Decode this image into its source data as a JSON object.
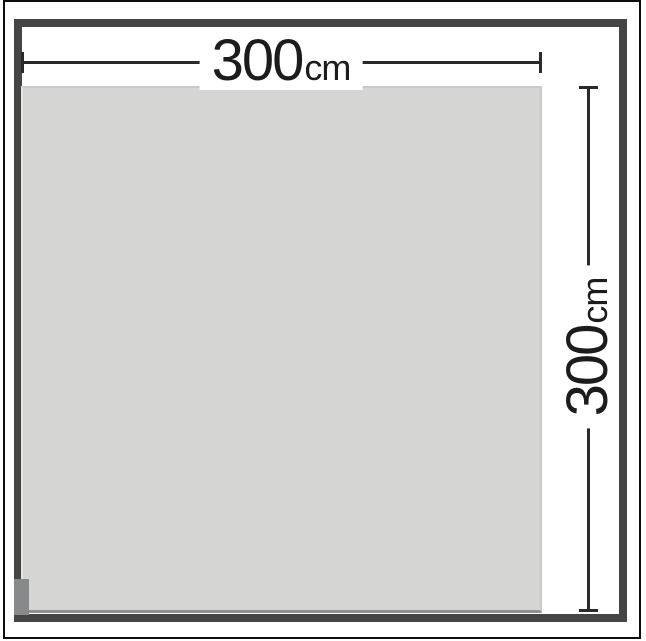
{
  "diagram": {
    "type": "product-dimension-diagram",
    "shape": "square-panel",
    "width_dimension": {
      "value": "300",
      "unit": "cm"
    },
    "height_dimension": {
      "value": "300",
      "unit": "cm"
    },
    "colors": {
      "canvas_background": "#ffffff",
      "outer_border": "#0d0d0d",
      "frame": "#454545",
      "panel_fill": "#d5d6d4",
      "panel_edge_light": "#e4e5e3",
      "panel_edge_dark": "#8f9091",
      "dimension_line": "#2a2a2a",
      "dimension_text": "#1c1c1c"
    }
  }
}
